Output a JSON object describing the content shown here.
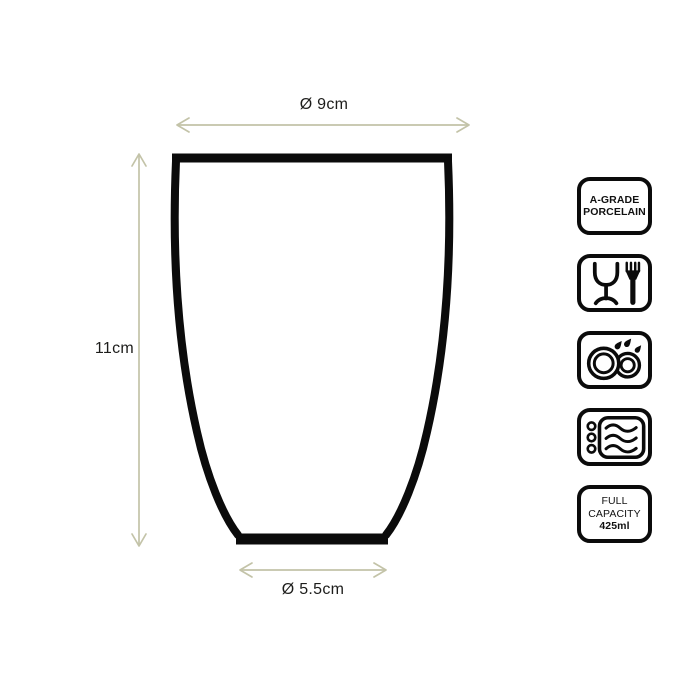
{
  "dimensions": {
    "top_diameter": "Ø 9cm",
    "height": "11cm",
    "base_diameter": "Ø 5.5cm"
  },
  "badges": {
    "porcelain": {
      "line1": "A-GRADE",
      "line2": "PORCELAIN"
    },
    "food_safe": {
      "icon": "glass-and-fork-icon"
    },
    "dishwasher_safe": {
      "icon": "dishwasher-plates-icon"
    },
    "microwave_safe": {
      "icon": "microwave-waves-icon"
    },
    "capacity": {
      "line1": "FULL",
      "line2": "CAPACITY",
      "line3": "425ml"
    }
  },
  "colors": {
    "outline": "#0b0b0b",
    "arrow": "#c3c3a8",
    "label_text": "#1d1d1b"
  }
}
